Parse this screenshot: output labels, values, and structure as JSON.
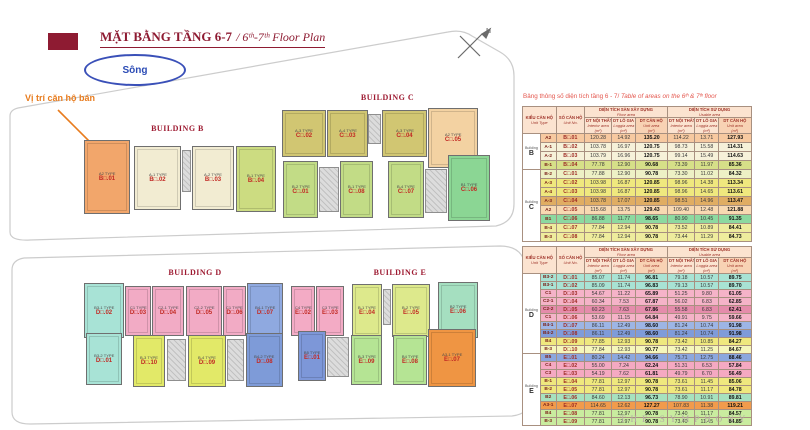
{
  "page": {
    "title_vn": "MẶT BẰNG TẦNG 6-7",
    "title_en": "/ 6ᵗʰ-7ᵗʰ Floor Plan",
    "river_label": "Sông",
    "sale_note": "Vị trí căn hộ bán",
    "compass_label": "N",
    "brand": "THE SYMPHONY",
    "caption_vn": "Bảng thông số diện tích tầng 6 - 7/ ",
    "caption_en": "Table of areas on the 6ᵗʰ & 7ᵗʰ floor"
  },
  "colors": {
    "maroon": "#8e1b32",
    "orange_accent": "#e87c1e",
    "river_blue": "#2b4bb5",
    "caption_red": "#e4574e",
    "table_header_text": "#9e3127",
    "table_header_bg": "#fbe3d0",
    "boundary_gray": "#cccccc"
  },
  "building_labels": {
    "b": "BUILDING B",
    "c": "BUILDING C",
    "d": "BUILDING D",
    "e": "BUILDING E"
  },
  "plan": {
    "b": [
      {
        "id": "B□.01",
        "type": "A2 TYPE"
      },
      {
        "id": "B□.02",
        "type": "A-1 TYPE"
      },
      {
        "id": "B□.03",
        "type": "A-2 TYPE"
      },
      {
        "id": "B□.04",
        "type": "B-1 TYPE"
      }
    ],
    "c_top": [
      {
        "id": "C□.02",
        "type": "A-3 TYPE"
      },
      {
        "id": "C□.03",
        "type": "A-4 TYPE"
      },
      {
        "id": "C□.04",
        "type": "A-3 TYPE"
      },
      {
        "id": "C□.05",
        "type": "A2 TYPE"
      }
    ],
    "c_bottom": [
      {
        "id": "C□.01",
        "type": "B-2 TYPE"
      },
      {
        "id": "C□.08",
        "type": "B-1 TYPE"
      },
      {
        "id": "C□.07",
        "type": "B-4 TYPE"
      },
      {
        "id": "C□.06",
        "type": "B1 TYPE"
      }
    ],
    "d_top": [
      {
        "id": "D□.02",
        "type": "B3-1 TYPE"
      },
      {
        "id": "D□.03",
        "type": "C1 TYPE"
      },
      {
        "id": "D□.04",
        "type": "C2-1 TYPE"
      },
      {
        "id": "D□.05",
        "type": "C2-2 TYPE"
      },
      {
        "id": "D□.06",
        "type": "C1 TYPE"
      },
      {
        "id": "D□.07",
        "type": "B4-1 TYPE"
      }
    ],
    "d_bottom": [
      {
        "id": "D□.01",
        "type": "B3-2 TYPE"
      },
      {
        "id": "D□.10",
        "type": "B-3 TYPE"
      },
      {
        "id": "D□.09",
        "type": "B-4 TYPE"
      },
      {
        "id": "D□.08",
        "type": "B4-2 TYPE"
      }
    ],
    "e_top": [
      {
        "id": "E□.02",
        "type": "C4 TYPE"
      },
      {
        "id": "E□.03",
        "type": "C3 TYPE"
      },
      {
        "id": "E□.04",
        "type": "B-1 TYPE"
      },
      {
        "id": "E□.05",
        "type": "B-2 TYPE"
      },
      {
        "id": "E□.06",
        "type": "B2 TYPE"
      }
    ],
    "e_bottom": [
      {
        "id": "E□.01",
        "type": "B5 TYPE"
      },
      {
        "id": "E□.09",
        "type": "B-3 TYPE"
      },
      {
        "id": "E□.08",
        "type": "B4 TYPE"
      },
      {
        "id": "E□.07",
        "type": "A3-1 TYPE"
      }
    ]
  },
  "headers": {
    "unit_type_vn": "KIỂU CĂN HỘ",
    "unit_type_en": "Unit Type",
    "unit_no_vn": "SỐ CĂN HỘ",
    "unit_no_en": "Unit No.",
    "floor_vn": "DIỆN TÍCH SÀN XÂY DỰNG",
    "floor_en": "Floor area",
    "use_vn": "DIỆN TÍCH SỬ DỤNG",
    "use_en": "Usable area",
    "interior_vn": "DT NỘI THẤT",
    "interior_en": "Interior area",
    "loggia_vn": "DT LÔ GIA",
    "loggia_en": "Loggia area",
    "unit_area_vn": "DT CĂN HỘ",
    "unit_area_en": "Unit area",
    "sqm": "(m²)"
  },
  "tables": {
    "bc": {
      "groups": [
        {
          "building": "Building",
          "letter": "B",
          "rows": [
            {
              "type": "A2",
              "unit": "B□.01",
              "v": [
                "120.28",
                "14.92",
                "135.20",
                "114.22",
                "13.71",
                "127.93"
              ],
              "c": "peach"
            },
            {
              "type": "A-1",
              "unit": "B□.02",
              "v": [
                "103.78",
                "16.97",
                "120.75",
                "98.73",
                "15.58",
                "114.31"
              ],
              "c": "cream"
            },
            {
              "type": "A-2",
              "unit": "B□.03",
              "v": [
                "103.79",
                "16.96",
                "120.75",
                "99.14",
                "15.49",
                "114.63"
              ],
              "c": "cream"
            },
            {
              "type": "B-1",
              "unit": "B□.04",
              "v": [
                "77.78",
                "12.90",
                "90.68",
                "73.39",
                "11.97",
                "85.36"
              ],
              "c": "ygreen"
            }
          ]
        },
        {
          "building": "Building",
          "letter": "C",
          "rows": [
            {
              "type": "B-2",
              "unit": "C□.01",
              "v": [
                "77.88",
                "12.90",
                "90.78",
                "73.30",
                "11.02",
                "84.32"
              ],
              "c": "paleyg"
            },
            {
              "type": "A-3",
              "unit": "C□.02",
              "v": [
                "103.98",
                "16.87",
                "120.85",
                "98.96",
                "14.38",
                "113.34"
              ],
              "c": "yellow"
            },
            {
              "type": "A-4",
              "unit": "C□.03",
              "v": [
                "103.98",
                "16.87",
                "120.85",
                "98.96",
                "14.65",
                "113.61"
              ],
              "c": "yellow"
            },
            {
              "type": "A-3",
              "unit": "C□.04",
              "v": [
                "103.78",
                "17.07",
                "120.85",
                "98.51",
                "14.96",
                "113.47"
              ],
              "c": "tan"
            },
            {
              "type": "A2",
              "unit": "C□.05",
              "v": [
                "115.68",
                "13.75",
                "129.43",
                "109.40",
                "12.48",
                "121.88"
              ],
              "c": "lpeach"
            },
            {
              "type": "B1",
              "unit": "C□.06",
              "v": [
                "86.88",
                "11.77",
                "98.65",
                "80.90",
                "10.45",
                "91.35"
              ],
              "c": "green"
            },
            {
              "type": "B-4",
              "unit": "C□.07",
              "v": [
                "77.84",
                "12.94",
                "90.78",
                "73.52",
                "10.89",
                "84.41"
              ],
              "c": "khaki"
            },
            {
              "type": "B-3",
              "unit": "C□.08",
              "v": [
                "77.84",
                "12.94",
                "90.78",
                "73.44",
                "11.29",
                "84.73"
              ],
              "c": "khaki"
            }
          ]
        }
      ]
    },
    "de": {
      "groups": [
        {
          "building": "Building",
          "letter": "D",
          "rows": [
            {
              "type": "B3-2",
              "unit": "D□.01",
              "v": [
                "85.07",
                "11.74",
                "96.81",
                "79.18",
                "10.57",
                "89.75"
              ],
              "c": "teal"
            },
            {
              "type": "B3-1",
              "unit": "D□.02",
              "v": [
                "85.09",
                "11.74",
                "96.83",
                "79.13",
                "10.57",
                "89.70"
              ],
              "c": "teal"
            },
            {
              "type": "C1",
              "unit": "D□.03",
              "v": [
                "54.67",
                "11.22",
                "65.89",
                "51.25",
                "9.80",
                "61.05"
              ],
              "c": "pink"
            },
            {
              "type": "C2-1",
              "unit": "D□.04",
              "v": [
                "60.34",
                "7.53",
                "67.87",
                "56.02",
                "6.83",
                "62.85"
              ],
              "c": "pink"
            },
            {
              "type": "C2-2",
              "unit": "D□.05",
              "v": [
                "60.23",
                "7.63",
                "67.86",
                "55.58",
                "6.83",
                "62.41"
              ],
              "c": "dpink"
            },
            {
              "type": "C1",
              "unit": "D□.06",
              "v": [
                "53.69",
                "11.15",
                "64.84",
                "49.91",
                "9.75",
                "59.66"
              ],
              "c": "pink"
            },
            {
              "type": "B4-1",
              "unit": "D□.07",
              "v": [
                "86.11",
                "12.49",
                "98.60",
                "81.24",
                "10.74",
                "91.98"
              ],
              "c": "blue"
            },
            {
              "type": "B4-2",
              "unit": "D□.08",
              "v": [
                "86.11",
                "12.49",
                "98.60",
                "81.24",
                "10.74",
                "91.98"
              ],
              "c": "dblue"
            },
            {
              "type": "B4",
              "unit": "D□.09",
              "v": [
                "77.85",
                "12.93",
                "90.78",
                "73.42",
                "10.85",
                "84.27"
              ],
              "c": "yellow"
            },
            {
              "type": "B-3",
              "unit": "D□.10",
              "v": [
                "77.84",
                "12.93",
                "90.77",
                "73.42",
                "11.25",
                "84.67"
              ],
              "c": "paleyellow"
            }
          ]
        },
        {
          "building": "Building",
          "letter": "E",
          "rows": [
            {
              "type": "B5",
              "unit": "E□.01",
              "v": [
                "80.24",
                "14.42",
                "94.66",
                "75.71",
                "12.75",
                "88.46"
              ],
              "c": "eblue"
            },
            {
              "type": "C4",
              "unit": "E□.02",
              "v": [
                "55.00",
                "7.24",
                "62.24",
                "51.31",
                "6.53",
                "57.84"
              ],
              "c": "epink"
            },
            {
              "type": "C3",
              "unit": "E□.03",
              "v": [
                "54.19",
                "7.62",
                "61.81",
                "49.79",
                "6.70",
                "56.49"
              ],
              "c": "epink"
            },
            {
              "type": "B-1",
              "unit": "E□.04",
              "v": [
                "77.81",
                "12.97",
                "90.78",
                "73.61",
                "11.45",
                "85.06"
              ],
              "c": "yellow"
            },
            {
              "type": "B-2",
              "unit": "E□.05",
              "v": [
                "77.81",
                "12.97",
                "90.78",
                "73.61",
                "11.17",
                "84.78"
              ],
              "c": "yellow"
            },
            {
              "type": "B2",
              "unit": "E□.06",
              "v": [
                "84.60",
                "12.13",
                "96.73",
                "78.90",
                "10.91",
                "89.81"
              ],
              "c": "teal2"
            },
            {
              "type": "A3-1",
              "unit": "E□.07",
              "v": [
                "114.65",
                "12.62",
                "127.27",
                "107.83",
                "11.38",
                "119.21"
              ],
              "c": "orange2"
            },
            {
              "type": "B4",
              "unit": "E□.08",
              "v": [
                "77.81",
                "12.97",
                "90.78",
                "73.40",
                "11.17",
                "84.57"
              ],
              "c": "lgreen"
            },
            {
              "type": "B-3",
              "unit": "E□.09",
              "v": [
                "77.81",
                "12.97",
                "90.78",
                "73.40",
                "11.45",
                "84.85"
              ],
              "c": "lgreen"
            }
          ]
        }
      ]
    }
  }
}
